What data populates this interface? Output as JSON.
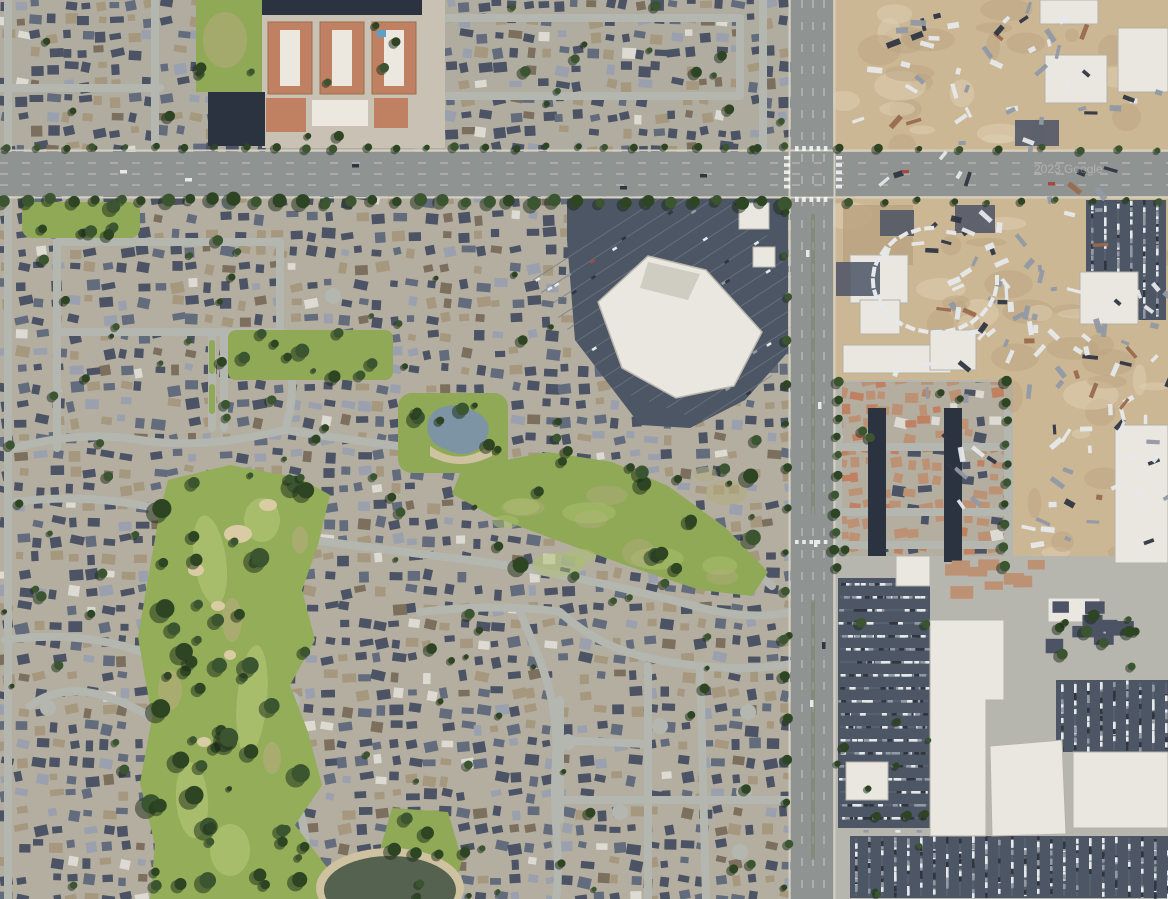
{
  "map": {
    "description": "Aerial satellite view of a suburban area: residential tracts around a golf course and linear parks, a big-box retail center, a major arterial intersection, industrial storage yards and a shopping center",
    "watermark": "2023 Google",
    "regions": [
      "residential-neighborhoods",
      "golf-course",
      "linear-park",
      "pond-park",
      "big-box-retail-center",
      "arterial-intersection",
      "industrial-storage-yards",
      "truck-depot",
      "condo-complex",
      "shopping-center",
      "apartment-complex",
      "school-field"
    ],
    "palette": {
      "ground": "#b3ae9f",
      "groundCool": "#aeaca2",
      "street": "#b4b7b0",
      "arterialRoad": "#8f9391",
      "laneLine": "#ffffff",
      "curb": "#d2cfc2",
      "houseDark": "#4b5365",
      "houseMid": "#636c7d",
      "houseLight": "#9aa0ad",
      "houseTan": "#a6977f",
      "houseBrown": "#7c6f5d",
      "roofWhite": "#dcdad2",
      "grass": "#8fa956",
      "grassDry": "#b2ab79",
      "golf": "#93ad58",
      "golfLight": "#abc06f",
      "sand": "#d9cba3",
      "treeDark": "#2e4523",
      "treeMid": "#3a5530",
      "treeShadow": "#1c2a18",
      "dirt": "#ccb795",
      "dirtShade": "#b9a17e",
      "dirtLight": "#e0d3b6",
      "parking": "#4d5665",
      "parkingLine": "#707a89",
      "whiteRoof": "#e9e7e0",
      "grayRoof": "#aeb2b4",
      "condoTan": "#bd9174",
      "aptRoof": "#c08163",
      "aptTrim": "#ece7df",
      "carport": "#2b3340",
      "pondWater": "#7d94a4",
      "lakeWater": "#55624f",
      "beach": "#cfc2a0",
      "pool": "#5aa0c8",
      "carWhite": "#e6e8ea",
      "carDark": "#2f3642",
      "carGray": "#9199a4",
      "carRed": "#a04b41",
      "watermarkColor": "#ffffff"
    }
  }
}
